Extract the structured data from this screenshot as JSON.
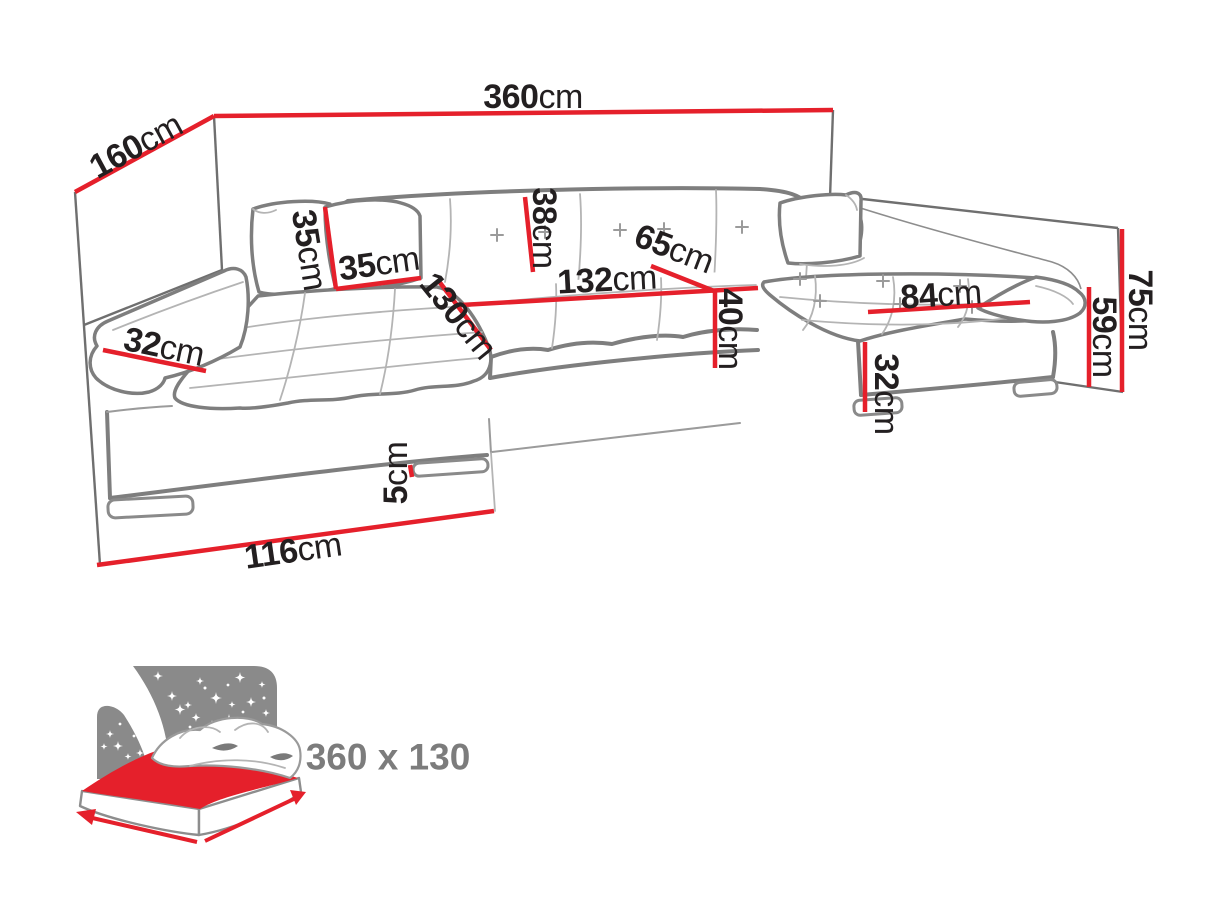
{
  "diagram": {
    "kind": "sofa-dimension-diagram",
    "unit": "cm"
  },
  "colors": {
    "dimension_line_red": "#e5202b",
    "label_text_dark": "#231f20",
    "sofa_outline_gray": "#7e7e7e",
    "wall_gray": "#6f6f6f",
    "icon_gray": "#8a8a8a",
    "sleeping_text_gray": "#7c7c7c"
  },
  "dimensions": [
    {
      "name": "total-width",
      "value": "360",
      "unit": "cm"
    },
    {
      "name": "left-side-depth",
      "value": "160",
      "unit": "cm"
    },
    {
      "name": "pillow-height",
      "value": "35",
      "unit": "cm"
    },
    {
      "name": "pillow-width",
      "value": "35",
      "unit": "cm"
    },
    {
      "name": "left-chaise-length",
      "value": "130",
      "unit": "cm"
    },
    {
      "name": "backrest-height",
      "value": "38",
      "unit": "cm"
    },
    {
      "name": "center-seat-length",
      "value": "132",
      "unit": "cm"
    },
    {
      "name": "seat-depth",
      "value": "65",
      "unit": "cm"
    },
    {
      "name": "seat-front-height",
      "value": "40",
      "unit": "cm"
    },
    {
      "name": "right-chaise-seat-length",
      "value": "84",
      "unit": "cm"
    },
    {
      "name": "right-base-height",
      "value": "32",
      "unit": "cm"
    },
    {
      "name": "right-backrest-height",
      "value": "59",
      "unit": "cm"
    },
    {
      "name": "total-height",
      "value": "75",
      "unit": "cm"
    },
    {
      "name": "left-armrest-width",
      "value": "32",
      "unit": "cm"
    },
    {
      "name": "left-end-width",
      "value": "116",
      "unit": "cm"
    },
    {
      "name": "leg-height",
      "value": "5",
      "unit": "cm"
    }
  ],
  "sleeping_area": {
    "label": "360 x 130",
    "icon": "bed-night-icon"
  }
}
